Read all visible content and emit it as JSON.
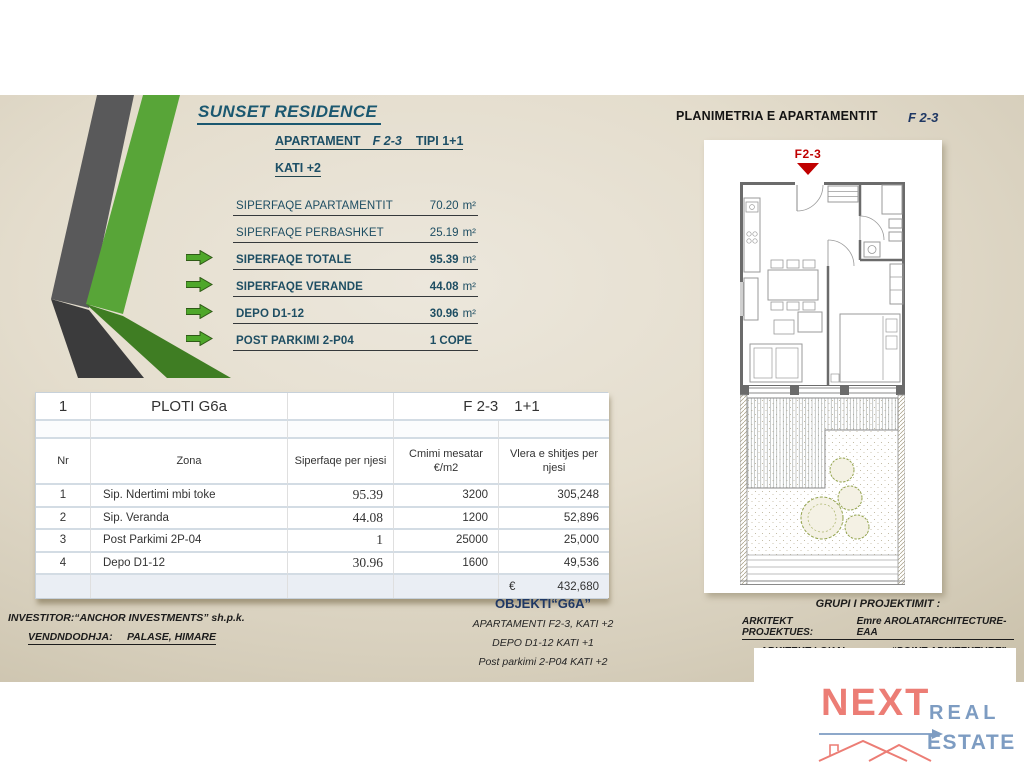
{
  "header": {
    "title": "SUNSET RESIDENCE",
    "apartment_label": "APARTAMENT",
    "apartment_unit": "F 2-3",
    "apartment_type": "TIPI 1+1",
    "floor": "KATI +2"
  },
  "specs": [
    {
      "label": "SIPERFAQE  APARTAMENTIT",
      "value": "70.20",
      "unit": "m²",
      "bold": false,
      "arrow": false
    },
    {
      "label": "SIPERFAQE PERBASHKET",
      "value": "25.19",
      "unit": "m²",
      "bold": false,
      "arrow": false
    },
    {
      "label": "SIPERFAQE TOTALE",
      "value": "95.39",
      "unit": "m²",
      "bold": true,
      "arrow": true
    },
    {
      "label": "SIPERFAQE  VERANDE",
      "value": "44.08",
      "unit": "m²",
      "bold": true,
      "arrow": true
    },
    {
      "label": "DEPO D1-12",
      "value": "30.96",
      "unit": "m²",
      "bold": true,
      "arrow": true
    },
    {
      "label": "POST PARKIMI 2-P04",
      "value": "1  COPE",
      "unit": "",
      "bold": true,
      "arrow": true
    }
  ],
  "table": {
    "plot_no": "1",
    "plot_name": "PLOTI G6a",
    "unit_code": "F 2-3",
    "unit_type": "1+1",
    "columns": [
      "Nr",
      "Zona",
      "Siperfaqe per njesi",
      "Cmimi mesatar €/m2",
      "Vlera e shitjes per njesi"
    ],
    "rows": [
      [
        "1",
        "Sip. Ndertimi mbi toke",
        "95.39",
        "3200",
        "305,248"
      ],
      [
        "2",
        "Sip. Veranda",
        "44.08",
        "1200",
        "52,896"
      ],
      [
        "3",
        "Post Parkimi 2P-04",
        "1",
        "25000",
        "25,000"
      ],
      [
        "4",
        "Depo  D1-12",
        "30.96",
        "1600",
        "49,536"
      ]
    ],
    "total_currency": "€",
    "total_value": "432,680"
  },
  "plan": {
    "section_title": "PLANIMETRIA E APARTAMENTIT",
    "unit_code": "F 2-3",
    "marker_label": "F2-3"
  },
  "footer": {
    "investor_line": "INVESTITOR:“ANCHOR INVESTMENTS” sh.p.k.",
    "location_label": "VENDNDODHJA:",
    "location_value": "PALASE, HIMARE",
    "object_title": "OBJEKTI“G6A”",
    "object_lines": [
      "APARTAMENTI  F2-3, KATI +2",
      "DEPO D1-12  KATI +1",
      "Post parkimi 2-P04  KATI +2"
    ],
    "design_group_title": "GRUPI I PROJEKTIMIT  :",
    "architect_label": "ARKITEKT PROJEKTUES:",
    "architect_value": "Emre AROLATARCHITECTURE-EAA",
    "local_architect_label": "ARKITEKT LOKAL:",
    "local_architect_value": "“POINT ARKITEKTURE”"
  },
  "logo": {
    "next": "NEXT",
    "real": "REAL",
    "estate": "ESTATE"
  },
  "colors": {
    "accent_green": "#4ea72a",
    "accent_green_dark": "#2f5a17",
    "band_gray": "#59595a",
    "band_gray_dark": "#3b3b3c",
    "band_green": "#58a538",
    "band_green_dark": "#3f7d23",
    "navy": "#1e4e63",
    "marker_red": "#c00000",
    "logo_salmon": "#ec7d75",
    "logo_blue": "#7d9cc2"
  }
}
